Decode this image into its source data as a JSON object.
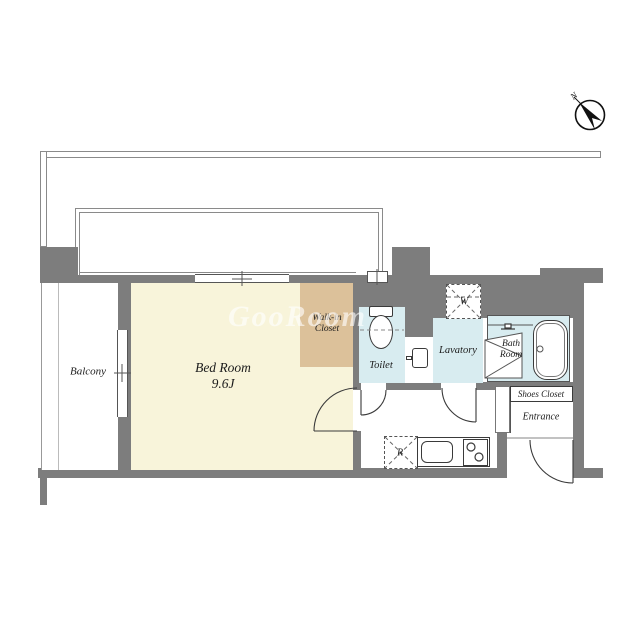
{
  "watermark": "GooRoom",
  "compass": {
    "label": "N"
  },
  "rooms": {
    "balcony": {
      "label": "Balcony"
    },
    "bedroom": {
      "label": "Bed Room",
      "size": "9.6J"
    },
    "walkin_closet": {
      "line1": "Walk-in",
      "line2": "Closet"
    },
    "toilet": {
      "label": "Toilet"
    },
    "lavatory": {
      "label": "Lavatory"
    },
    "bathroom": {
      "line1": "Bath",
      "line2": "Room"
    },
    "shoes_closet": {
      "label": "Shoes Closet"
    },
    "entrance": {
      "label": "Entrance"
    }
  },
  "fixtures": {
    "washer": "W",
    "refrigerator": "R"
  },
  "colors": {
    "wall": "#7d7d7d",
    "bedroom": "#f8f4da",
    "closet": "#dcc19a",
    "wet": "#d8ecf0",
    "line": "#3a3a3a"
  }
}
